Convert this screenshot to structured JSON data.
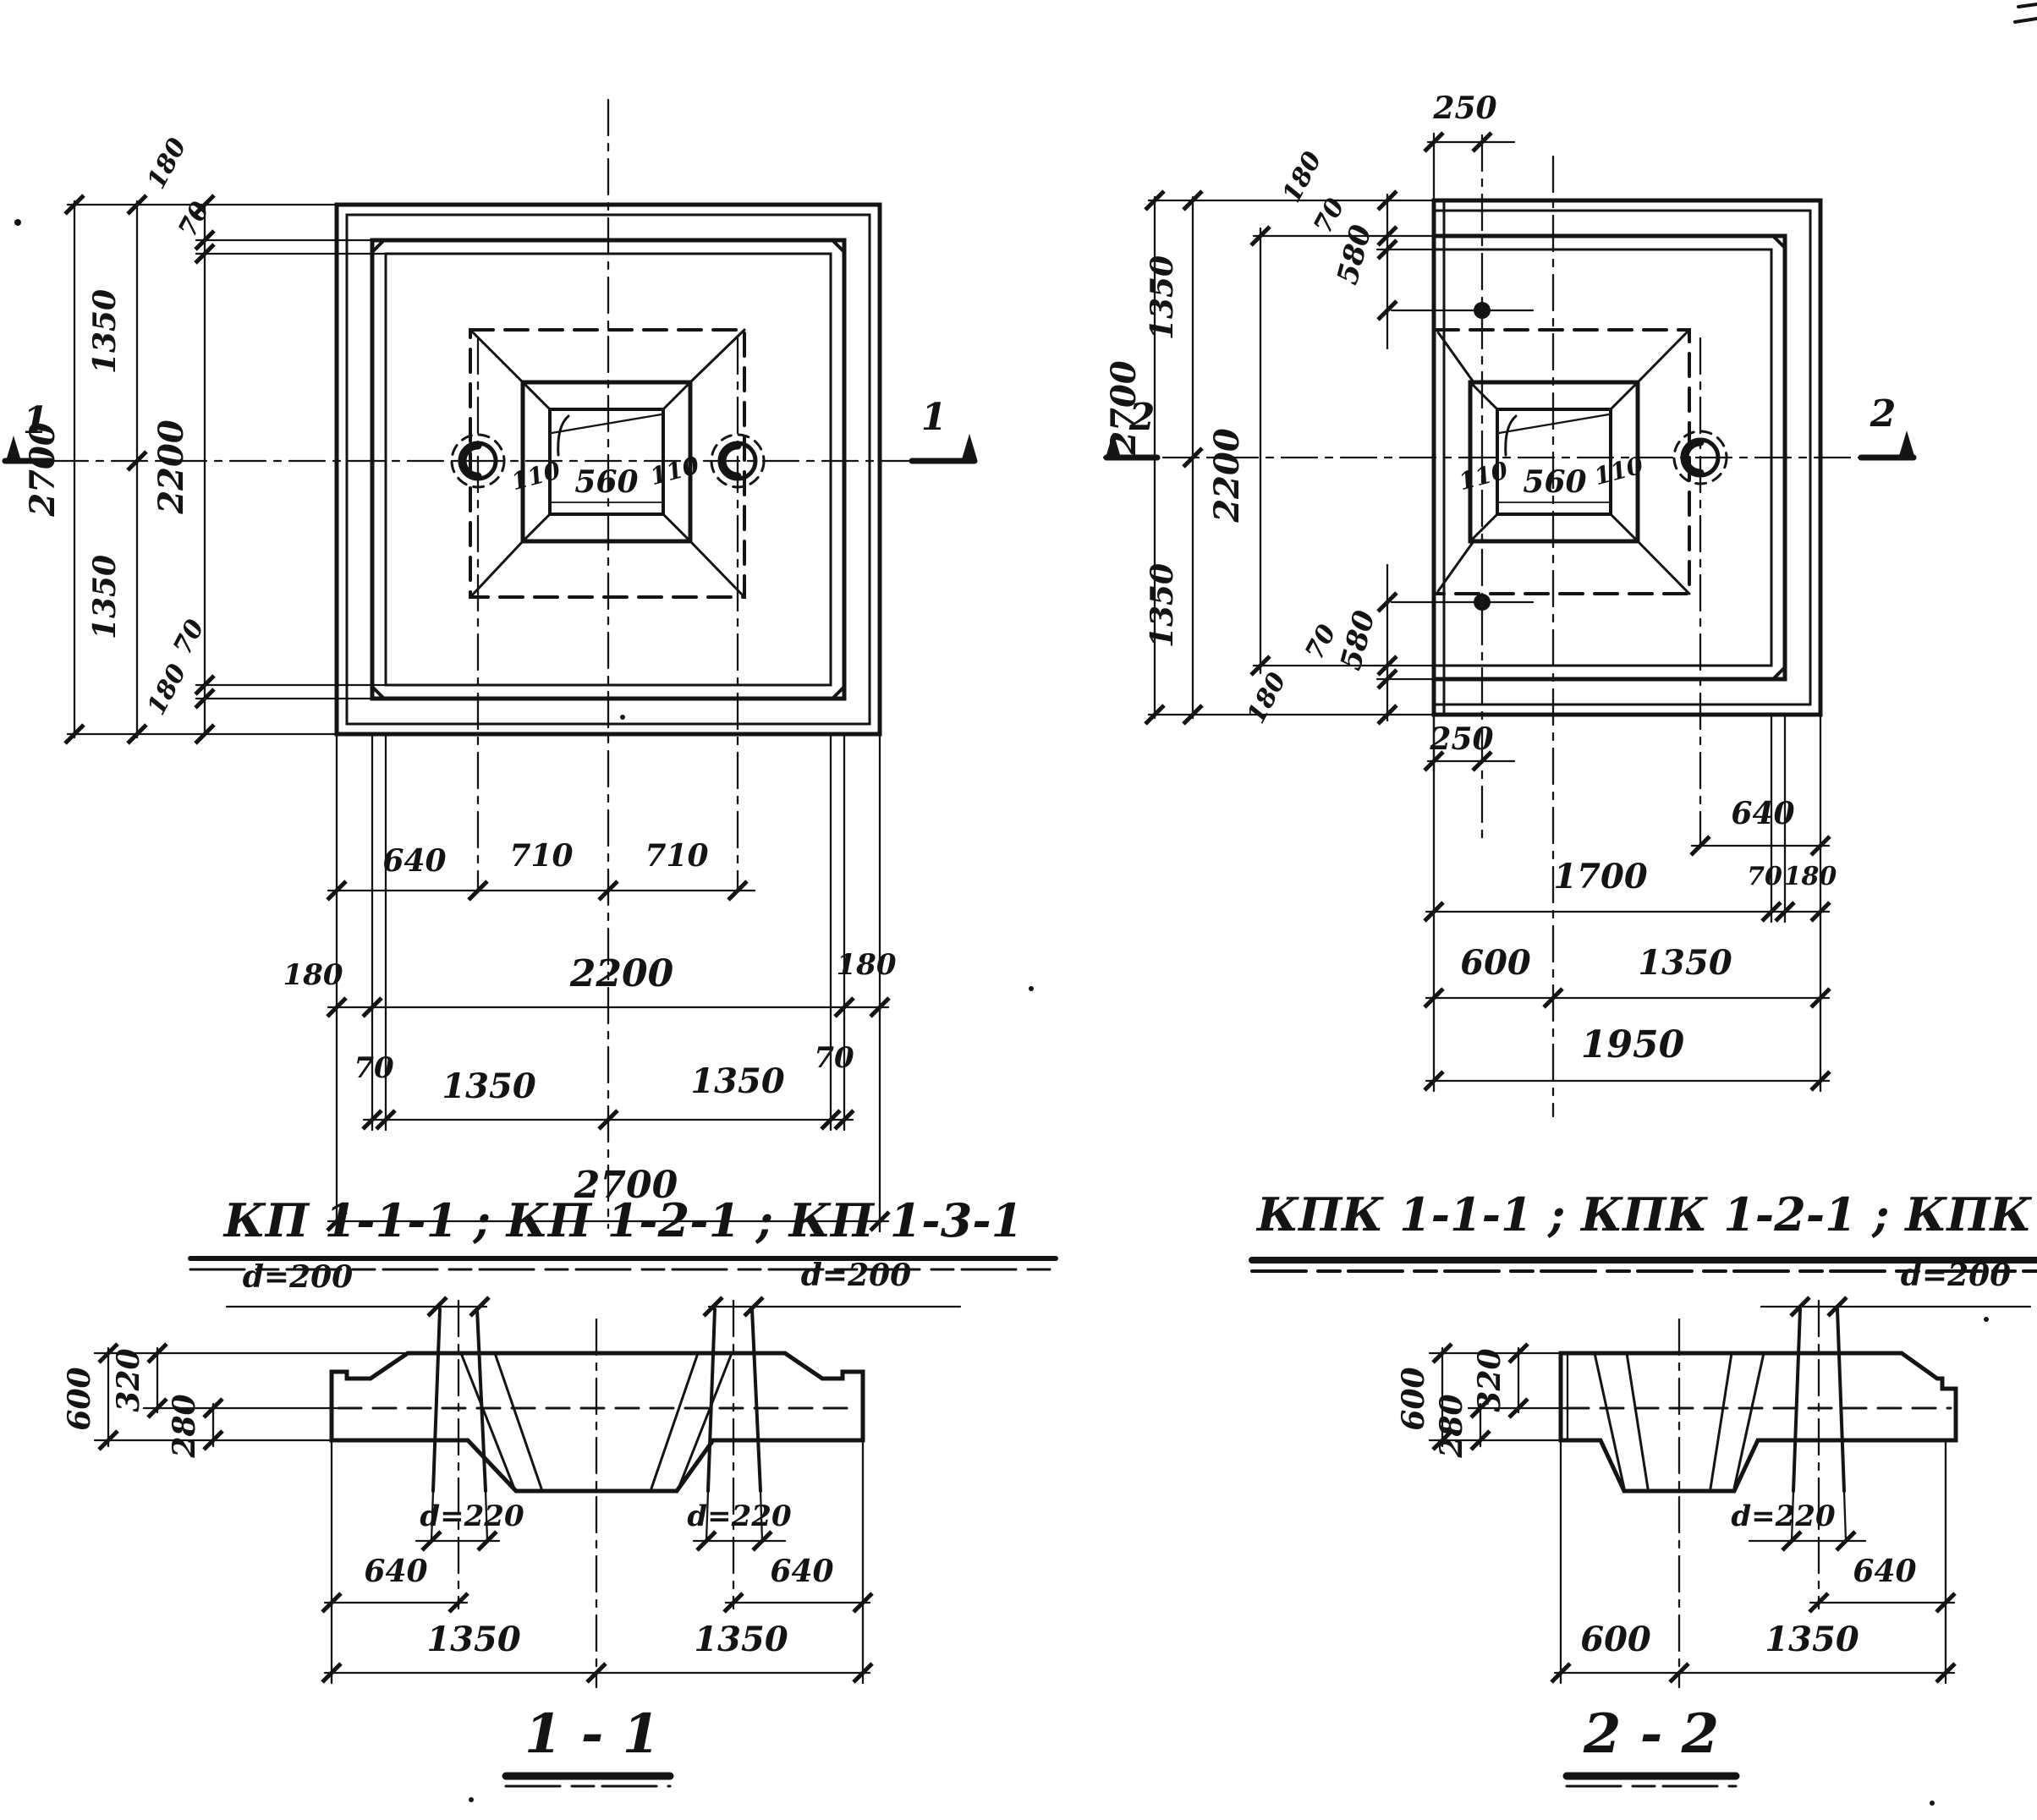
{
  "drawing": {
    "plan_kp": {
      "title": "КП 1-1-1 ; КП 1-2-1 ; КП 1-3-1",
      "marker": "1",
      "dim_2700": "2700",
      "dim_1350": "1350",
      "dim_2200": "2200",
      "dim_180": "180",
      "dim_70": "70",
      "dim_640": "640",
      "dim_710": "710",
      "dim_560": "560",
      "dim_110": "110"
    },
    "plan_kpk": {
      "title": "КПК 1-1-1 ; КПК 1-2-1 ; КПК 1-3-1",
      "marker": "2",
      "dim_2700": "2700",
      "dim_1350": "1350",
      "dim_2200": "2200",
      "dim_180": "180",
      "dim_70": "70",
      "dim_580": "580",
      "dim_250": "250",
      "dim_640": "640",
      "dim_1700": "1700",
      "dim_600": "600",
      "dim_1950": "1950",
      "dim_560": "560",
      "dim_110": "110"
    },
    "section_1": {
      "title": "1 - 1",
      "d200": "d=200",
      "d220": "d=220",
      "dim_600": "600",
      "dim_320": "320",
      "dim_280": "280",
      "dim_640": "640",
      "dim_1350": "1350"
    },
    "section_2": {
      "title": "2 - 2",
      "d200": "d=200",
      "d220": "d=220",
      "dim_600": "600",
      "dim_320": "320",
      "dim_280": "280",
      "dim_640": "640",
      "dim_1350": "1350"
    }
  }
}
